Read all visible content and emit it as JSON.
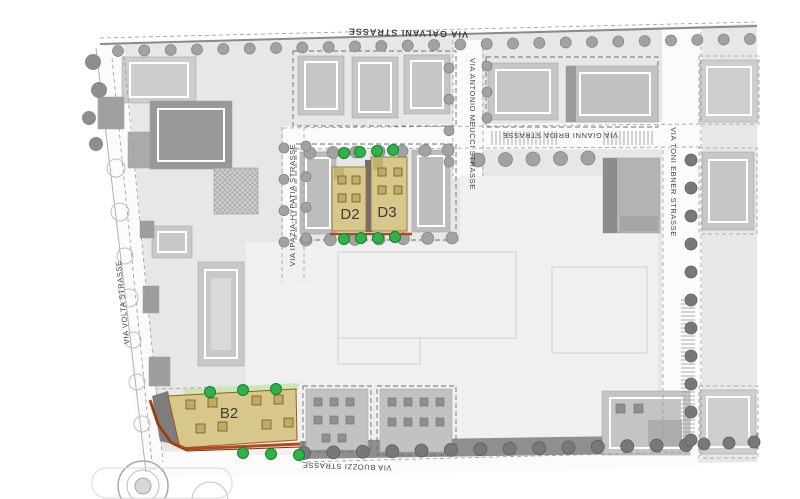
{
  "map": {
    "streets": {
      "top": "VIA GALVANI STRASSE",
      "left": "VIA VOLTA STRASSE",
      "ipazia": "VIA IPAZIA-HYPATIA STRASSE",
      "meucci": "VIA ANTONIO MEUCCI STRASSE",
      "brida": "VIA GIANNI BRIDA STRASSE",
      "ebner": "VIA TONI EBNER STRASSE",
      "bottom": "VIA BUOZZI STRASSE"
    },
    "plots": {
      "b2": "B2",
      "d2": "D2",
      "d3": "D3"
    },
    "colors": {
      "highlight_fill": "#d8c78b",
      "highlight_stroke": "#9a7a3e",
      "accent_orange": "#b44a16",
      "accent_dark_red": "#7e2f10",
      "tree_green": "#2fb349",
      "green_strip": "#cbe7ba",
      "ground": "#e7e7e7",
      "pale_area": "#f0f0f0",
      "label_gray": "#3f3f3f"
    }
  }
}
